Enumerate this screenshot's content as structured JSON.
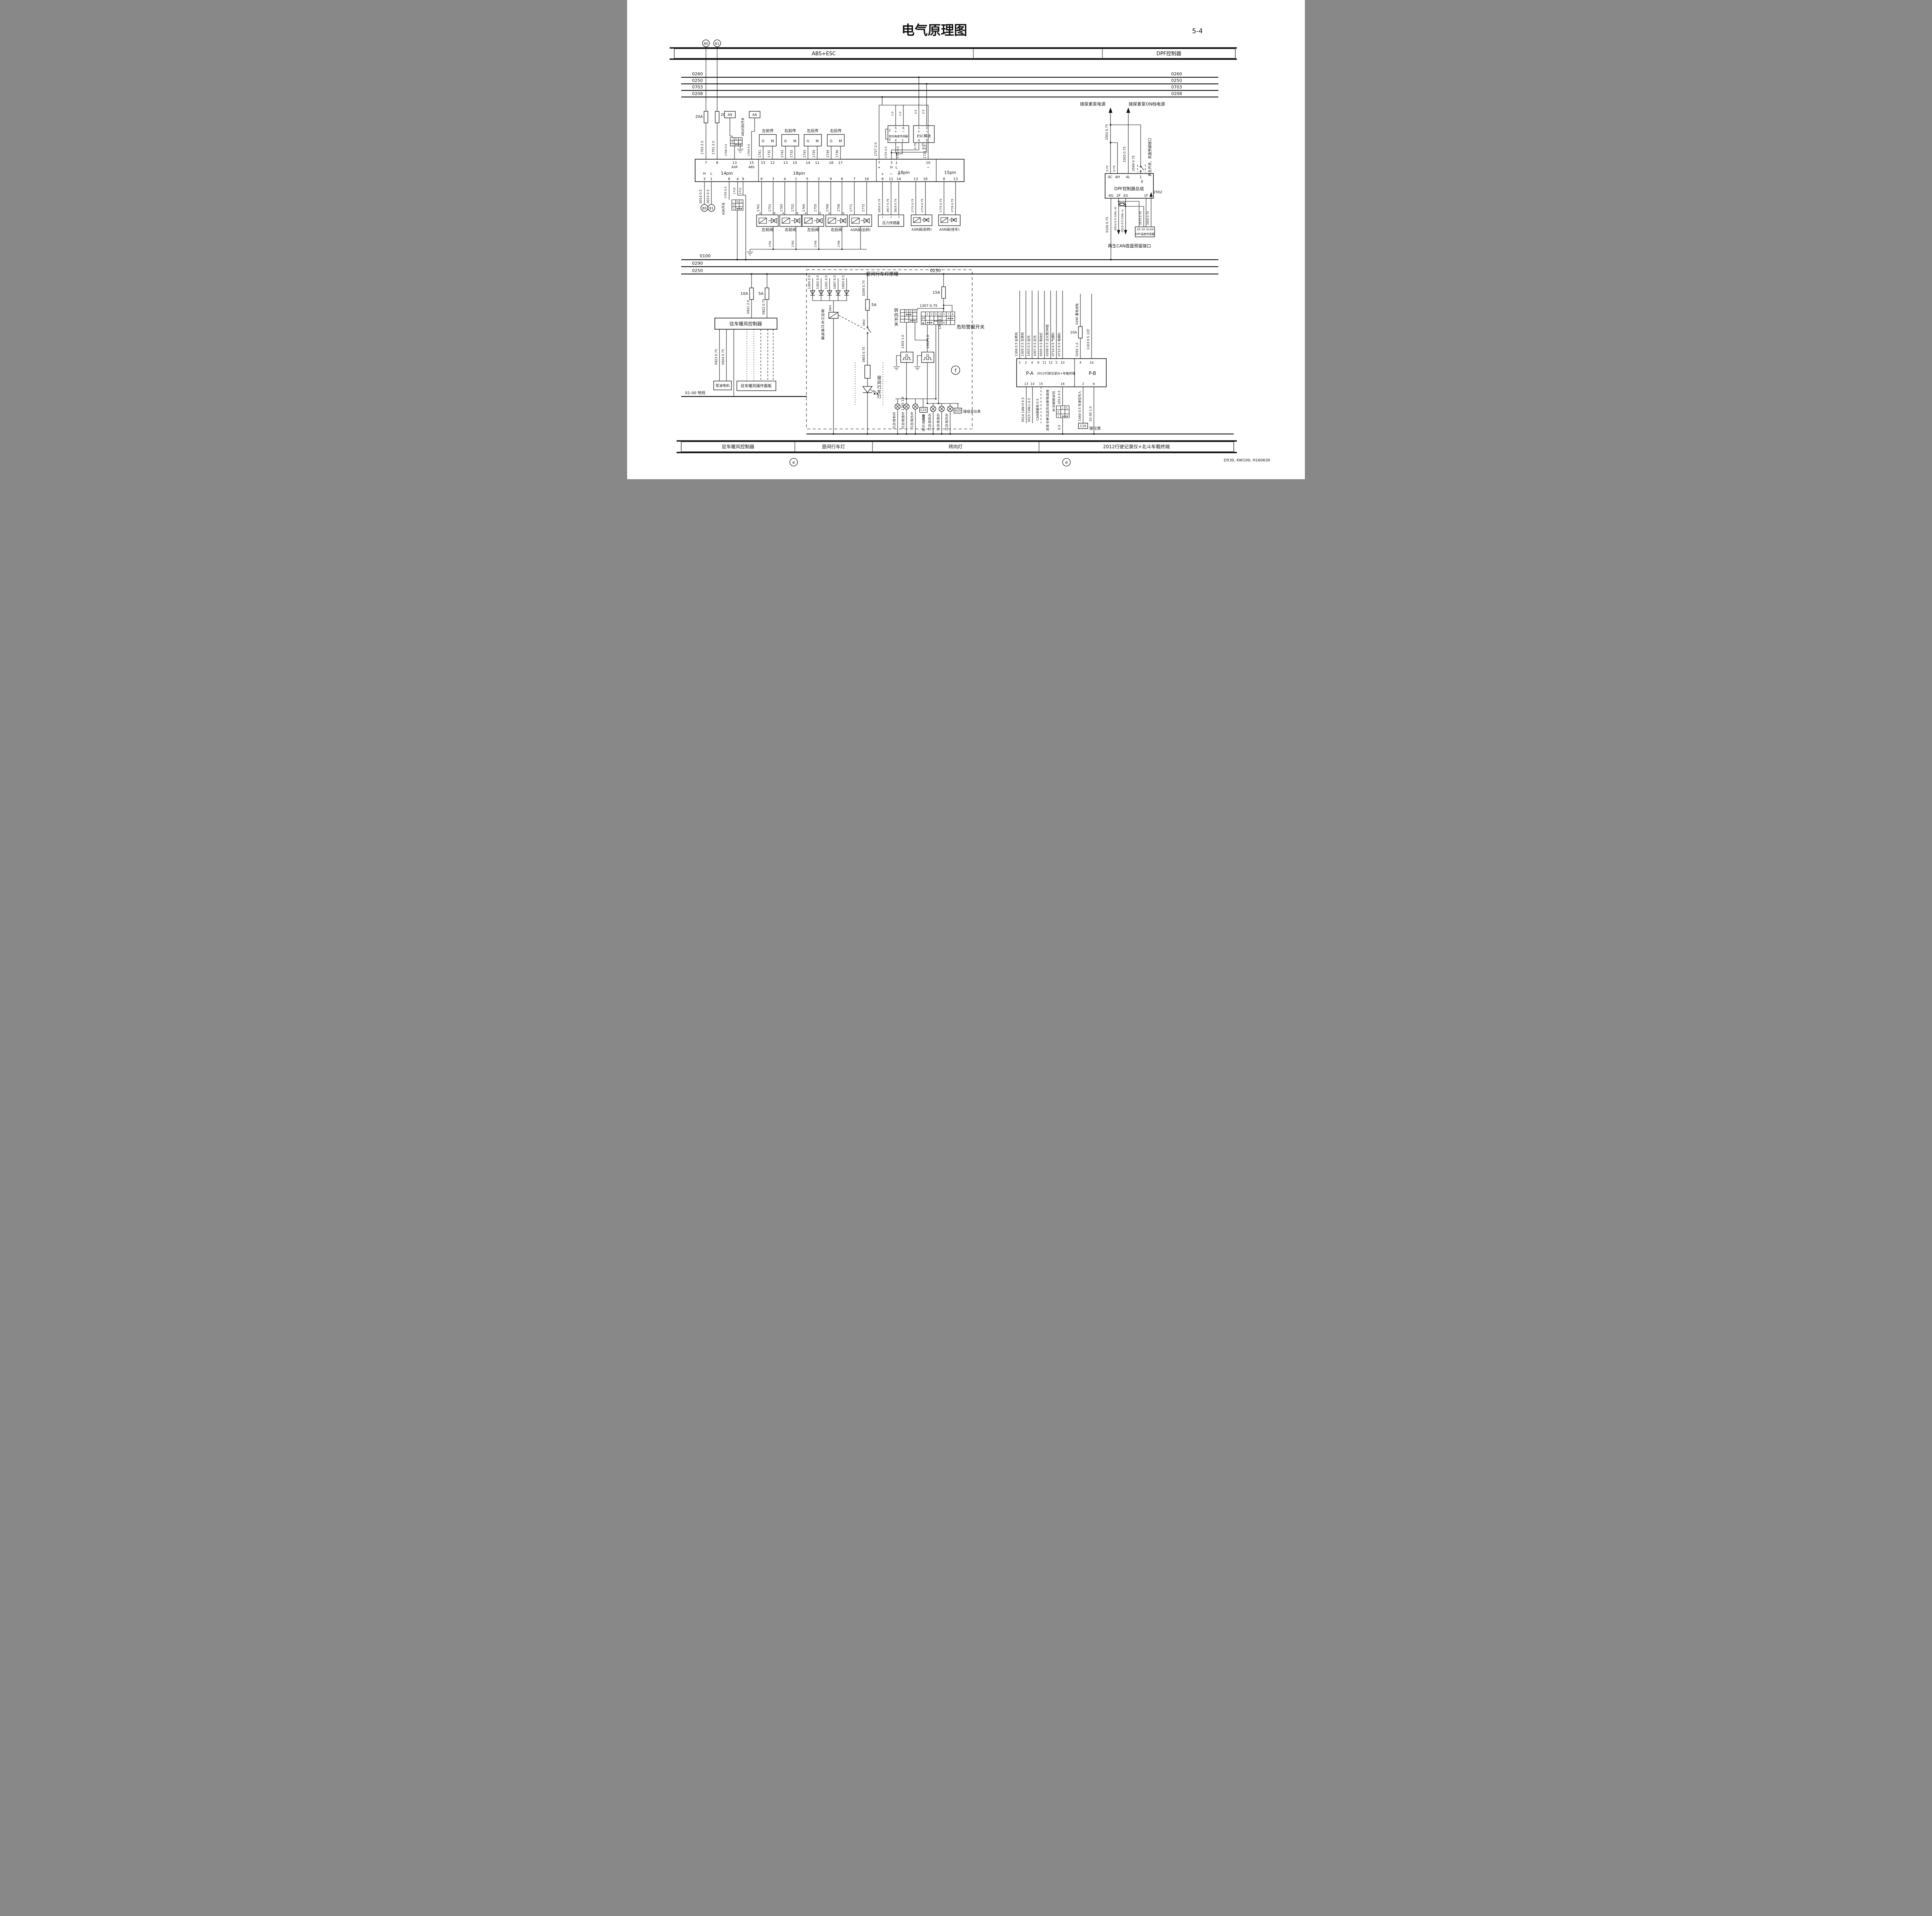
{
  "page": {
    "title": "电气原理图",
    "page_no": "5-4",
    "doc_code": "D530, KW100, H160630"
  },
  "header": {
    "s1": "ABS+ESC",
    "s3": "DPF控制器"
  },
  "bus": {
    "t1": "0260",
    "t2": "0250",
    "t3": "0703",
    "t4": "0208",
    "g1": "0100",
    "l1": "0290",
    "l2": "0250",
    "tap": "0250",
    "gnd_label": "01-00 地线"
  },
  "abs": {
    "f1": "20A",
    "f2": "20A",
    "w1703": "1703 2.5",
    "w1701": "1701 2.5",
    "a9": "A9",
    "a6": "A6",
    "flash_sw": "ABS闪码开关",
    "w1706": "1706 0.5",
    "w1704": "1704 0.5",
    "flash_cells": [
      "5",
      "1",
      "0",
      "1"
    ],
    "asr_cells": [
      "5",
      "1",
      "0",
      "1"
    ],
    "g": "G",
    "m": "M",
    "sensors": [
      {
        "n": "左前传",
        "a": "1741",
        "b": "1731"
      },
      {
        "n": "右前传",
        "a": "1742",
        "b": "1732"
      },
      {
        "n": "左后传",
        "a": "1745",
        "b": "1735"
      },
      {
        "n": "右后传",
        "a": "1746",
        "b": "1736"
      }
    ],
    "ecu": {
      "p14": "14pin",
      "p18": "18pin",
      "p18b": "18pin",
      "p15": "15pin",
      "h": "H",
      "l": "L",
      "p14_top": [
        "7",
        "8",
        "13",
        "15"
      ],
      "asr": "ASR",
      "abs": "ABS",
      "p14_bot": [
        "3",
        "1",
        "6",
        "4",
        "9"
      ],
      "p18_top": [
        "15",
        "12",
        "13",
        "10",
        "14",
        "11",
        "18",
        "17"
      ],
      "p18_bot": [
        "6",
        "3",
        "4",
        "1",
        "5",
        "2",
        "9",
        "8",
        "7",
        "16"
      ],
      "p18b_top": [
        "7",
        "3",
        "1",
        "10"
      ],
      "p18b_sub": [
        "+",
        "H",
        "L",
        "−"
      ],
      "p18b_bsub": [
        "+",
        "−",
        "S"
      ],
      "p18b_bot": [
        "8",
        "11",
        "14",
        "13",
        "16"
      ],
      "p15_bot": [
        "8",
        "13"
      ]
    },
    "w0014": "0014 0.5",
    "w0015": "0015 0.5",
    "t80": "80",
    "t81": "81",
    "asr_sw": "ASR开关",
    "w1705": "1705 0.5",
    "w1710": "1710",
    "w1711": "1711",
    "vw": [
      "1761",
      "1751",
      "1762",
      "1752",
      "1765",
      "1755",
      "1766",
      "1756",
      "1771",
      "1772"
    ],
    "a": "A",
    "e": "E",
    "valves": [
      "左前阀",
      "右前阀",
      "左后阀",
      "右后阀"
    ],
    "asr_rear": "ASR阀(后桥)",
    "lw": [
      "1791",
      "1792",
      "1795",
      "1796"
    ],
    "ss_name": "转向角度传感器",
    "ss": {
      "p5": "5",
      "p6": "6",
      "plus": "+",
      "minus": "−",
      "p2": "2",
      "p3": "3",
      "p4": "4",
      "p1": "1"
    },
    "ss_w": [
      "1.0",
      "1.0"
    ],
    "esc_name": "ESC模块",
    "esc": {
      "p1": "1",
      "p2": "2",
      "plus": "+",
      "minus": "−",
      "p4": "4",
      "p3": "3"
    },
    "esc_wt": [
      "2.5",
      "2.5"
    ],
    "esc_wb": [
      "0.75",
      "0.75"
    ],
    "w1727": "1727 2.0",
    "w1725": "1725 0.5",
    "w1722": "1722 0.5",
    "w1721": "1721 2.5",
    "ps_name": "压力传感器",
    "ps_pins": [
      "1",
      "2",
      "3"
    ],
    "ps_w": [
      "2816 0.75",
      "2817 0.75",
      "2818 0.75"
    ],
    "asr_front": "ASR阀(前桥)",
    "fw": [
      "1773 0.75",
      "1774 0.75"
    ],
    "asr_tr": "ASR阀(挂车)",
    "tw": [
      "1775 0.75",
      "1776 0.75"
    ]
  },
  "dpf": {
    "urea1": "接尿素泵电源",
    "urea2": "接尿素泵ON档电源",
    "note": "再生开关，底盘预留接口",
    "w2502": "2502 0.75",
    "w2503": "2503 0.75",
    "w2599": "2599 0.75",
    "wa": "0.75",
    "wb": "0.75",
    "box": "DPF控制器总成",
    "top": [
      "4C",
      "4H",
      "4L",
      "1"
    ],
    "e": "E",
    "bot": [
      "4G",
      "2F",
      "2G",
      "1F"
    ],
    "w0100": "0100 0.75",
    "canh": "0014 0.5 CAN—H",
    "canl": "0015 0.5 CAN—L",
    "w2573": "2573 0.75",
    "w2502b": "2502 0.75",
    "a2502": "2502",
    "ts": "DPF温度传感器",
    "ts_pins": [
      "03",
      "02",
      "01",
      "04"
    ],
    "regen": "再生CAN底盘预留接口"
  },
  "heater": {
    "f10": "10A",
    "f5": "5A",
    "w0921": "0921 2.0",
    "w0922": "0922 0.75",
    "ctrl": "驻车暖风控制器",
    "w0923": "0923 0.75",
    "w0924": "0924 0.75",
    "pump": "泵油电机",
    "panel": "驻车暖风操作面板"
  },
  "drl": {
    "title": "昼间行车灯原理",
    "dw": [
      "1304 0.5",
      "1302 0.5",
      "1201 0.5",
      "1007 0.5",
      "1003 0.5"
    ],
    "w0209": "0209 0.75",
    "f5": "5A",
    "w3801": "3801",
    "w3802": "3802",
    "w3803": "3803 0.75",
    "relay": "昼间行车灯继电器",
    "lamp": "昼间行车灯"
  },
  "turn": {
    "f15": "15A",
    "w1301": "1301 1.5",
    "w1307": "1307 0.75",
    "tsw": "转向开关",
    "tsw_cols": [
      "3",
      "1",
      "2"
    ],
    "hz": "危险警报开关",
    "hz_cols": [
      "1",
      "2",
      "3",
      "4",
      "5",
      "7",
      "8"
    ],
    "off": "OFF",
    "warn": "▲",
    "w1304": "1304 1.0",
    "w1302": "1302 1.0",
    "g1": "G",
    "g2": "G",
    "w1305": "1305 1.0",
    "w1306": "1306 1.0",
    "ll": [
      "左前转向灯",
      "左侧转向灯",
      "左后转向灯"
    ],
    "rl": [
      "右前转向灯",
      "右侧转向灯",
      "右后转向灯"
    ],
    "c22": "C22",
    "a29": "A29",
    "cl": "接组合仪表",
    "cr": "接组合仪表",
    "f": "f"
  },
  "rec": {
    "pa": "P-A",
    "pb": "P-B",
    "name": "2012行驶记录仪+车载终端",
    "top": [
      "1",
      "2",
      "4",
      "9",
      "11",
      "12",
      "5",
      "10",
      "4",
      "16"
    ],
    "tw": [
      "1306 0.5 右转向",
      "1305 0.5 左转向",
      "1003 0.5 远光",
      "1007 0.5 近光",
      "0505 0.5 制动灯",
      "0208 0.5 点火锁ON档",
      "0714 0.5 气喇叭",
      "0715 0.5 电喇叭"
    ],
    "f10": "10A",
    "w0292": "0292 1.0",
    "w0290": "0290 蓄电池电",
    "w1103": "1103 0.5 小灯",
    "bot": [
      "13",
      "14",
      "15",
      "16",
      "2",
      "6"
    ],
    "canh": "0014 CAN H 0.5",
    "canl": "0015 CAN L 0.5",
    "shield": "CAN屏蔽地 0.5",
    "note": "使用屏蔽双绞线时集中接地",
    "w2012": "2012 0.5",
    "alarm": "应急报警开关",
    "alarm_cells": [
      "1",
      "5",
      "0",
      "1"
    ],
    "w05": "0.5",
    "speed": "14A0 0.5 车速信号入",
    "c19": "C19",
    "meter": "接仪表",
    "w0100": "01-00 1.0"
  },
  "footer": {
    "secs": [
      "驻车暖风控制器",
      "昼间行车灯",
      "转向灯",
      "2012行驶记录仪+北斗车载终端"
    ],
    "e1": "e",
    "e2": "e",
    "t80": "80",
    "t81": "81"
  }
}
